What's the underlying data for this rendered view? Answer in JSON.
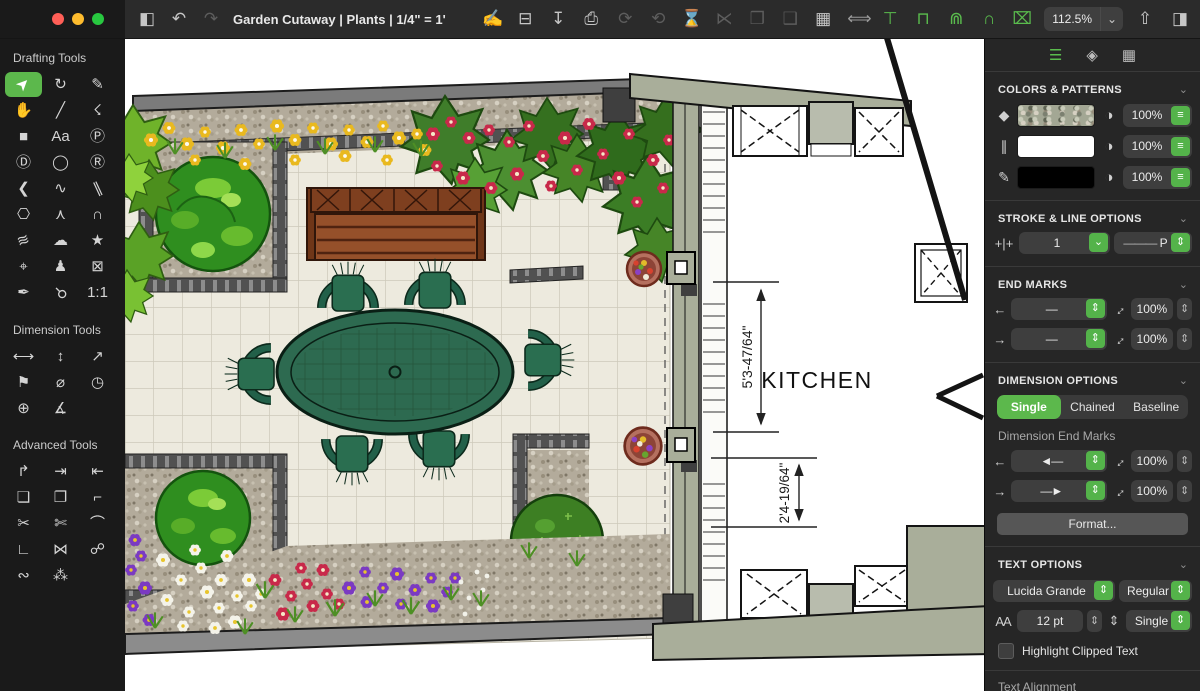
{
  "window": {
    "title": "Garden Cutaway | Plants | 1/4\" = 1'"
  },
  "colors": {
    "accent_green": "#5abc4d",
    "selected_tool_bg": "#5cb84c",
    "titlebar_bg": "#2b2b2b",
    "sidebar_bg": "#1a1a1a",
    "panel_bg": "#262626",
    "traffic": [
      "#ff5f57",
      "#febc2e",
      "#28c840"
    ]
  },
  "titlebar": {
    "nav": [
      {
        "name": "sidebar-toggle-icon",
        "glyph": "◧"
      },
      {
        "name": "undo-icon",
        "glyph": "↶"
      },
      {
        "name": "redo-icon",
        "glyph": "↷",
        "disabled": true
      }
    ],
    "file_tools": [
      {
        "name": "new-document-icon",
        "glyph": "✍"
      },
      {
        "name": "open-folder-icon",
        "glyph": "⊟"
      },
      {
        "name": "import-icon",
        "glyph": "↧"
      },
      {
        "name": "print-icon",
        "glyph": "⎙"
      }
    ],
    "edit_tools": [
      {
        "name": "rotate-cw-icon",
        "glyph": "⟳",
        "disabled": true
      },
      {
        "name": "rotate-ccw-icon",
        "glyph": "⟲",
        "disabled": true
      },
      {
        "name": "flip-vertical-icon",
        "glyph": "⌛",
        "disabled": true
      },
      {
        "name": "flip-horizontal-icon",
        "glyph": "⋉",
        "disabled": true
      },
      {
        "name": "group-icon",
        "glyph": "❒",
        "disabled": true
      },
      {
        "name": "ungroup-icon",
        "glyph": "❑",
        "disabled": true
      },
      {
        "name": "grid-icon",
        "glyph": "▦"
      }
    ],
    "dimension_tools": [
      {
        "name": "dimension-line-icon",
        "glyph": "⟺",
        "gray": true
      },
      {
        "name": "dimension-text-icon",
        "glyph": "⊤",
        "green": true
      },
      {
        "name": "dimension-arc-icon",
        "glyph": "⊓",
        "green": true
      },
      {
        "name": "dimension-double-arc-icon",
        "glyph": "⋒",
        "green": true
      },
      {
        "name": "dimension-over-arc-icon",
        "glyph": "∩",
        "green": true
      },
      {
        "name": "dimension-xy-icon",
        "glyph": "⌧",
        "green": true
      }
    ],
    "zoom": {
      "value": "112.5%",
      "chevron": "⌄"
    },
    "right_tools": [
      {
        "name": "share-icon",
        "glyph": "⇧"
      },
      {
        "name": "inspector-toggle-icon",
        "glyph": "◨"
      }
    ]
  },
  "sidebar": {
    "drafting_title": "Drafting Tools",
    "dimension_title": "Dimension Tools",
    "advanced_title": "Advanced Tools",
    "drafting_tools": [
      {
        "name": "select-tool",
        "glyph": "➤",
        "rot": -45,
        "selected": true
      },
      {
        "name": "rotate-tool",
        "glyph": "↻"
      },
      {
        "name": "reshape-tool",
        "glyph": "✎"
      },
      {
        "name": "pan-tool",
        "glyph": "✋"
      },
      {
        "name": "line-tool",
        "glyph": "╱"
      },
      {
        "name": "polyline-tool",
        "glyph": "☇"
      },
      {
        "name": "rectangle-tool",
        "glyph": "■"
      },
      {
        "name": "text-tool",
        "glyph": "Aa"
      },
      {
        "name": "text-box-tool",
        "glyph": "Ⓟ"
      },
      {
        "name": "circle-diameter-tool",
        "glyph": "Ⓓ"
      },
      {
        "name": "oval-tool",
        "glyph": "◯"
      },
      {
        "name": "rotated-rect-tool",
        "glyph": "Ⓡ"
      },
      {
        "name": "chevron-tool",
        "glyph": "❮"
      },
      {
        "name": "curve-tool",
        "glyph": "∿"
      },
      {
        "name": "parallel-line-tool",
        "glyph": "∥",
        "rot": -25
      },
      {
        "name": "polygon-tool",
        "glyph": "⎔"
      },
      {
        "name": "bezier-tool",
        "glyph": "⋏"
      },
      {
        "name": "arc-tool",
        "glyph": "∩"
      },
      {
        "name": "scribble-tool",
        "glyph": "≋",
        "rot": -20
      },
      {
        "name": "blob-tool",
        "glyph": "☁"
      },
      {
        "name": "star-tool",
        "glyph": "★"
      },
      {
        "name": "position-tool",
        "glyph": "⌖"
      },
      {
        "name": "stamp-tool",
        "glyph": "♟"
      },
      {
        "name": "no-fill-box-tool",
        "glyph": "⊠"
      },
      {
        "name": "eyedropper-tool",
        "glyph": "✒"
      },
      {
        "name": "magnifier-tool",
        "glyph": "⚲",
        "rot": 135
      },
      {
        "name": "actual-size-tool",
        "glyph": "1:1"
      }
    ],
    "dimension_tools": [
      {
        "name": "horizontal-dimension-tool",
        "glyph": "⟷"
      },
      {
        "name": "vertical-dimension-tool",
        "glyph": "↕"
      },
      {
        "name": "diagonal-dimension-tool",
        "glyph": "↗"
      },
      {
        "name": "angled-dimension-tool",
        "glyph": "⚑"
      },
      {
        "name": "diameter-dimension-tool",
        "glyph": "⌀"
      },
      {
        "name": "radius-dimension-tool",
        "glyph": "◷"
      },
      {
        "name": "center-dimension-tool",
        "glyph": "⊕"
      },
      {
        "name": "angle-dimension-tool",
        "glyph": "∡"
      }
    ],
    "advanced_tools": [
      {
        "name": "insert-vertex-tool",
        "glyph": "↱"
      },
      {
        "name": "extend-left-tool",
        "glyph": "⇥"
      },
      {
        "name": "extend-right-tool",
        "glyph": "⇤"
      },
      {
        "name": "combine-fill-tool",
        "glyph": "❏"
      },
      {
        "name": "combine-outline-tool",
        "glyph": "❐"
      },
      {
        "name": "path-node-tool",
        "glyph": "⌐"
      },
      {
        "name": "cut-tool",
        "glyph": "✂"
      },
      {
        "name": "multi-cut-tool",
        "glyph": "✄"
      },
      {
        "name": "fillet-tool",
        "glyph": "⌒"
      },
      {
        "name": "chamfer-tool",
        "glyph": "∟"
      },
      {
        "name": "mirror-tool",
        "glyph": "⋈"
      },
      {
        "name": "link-tool",
        "glyph": "☍"
      },
      {
        "name": "chain-tool",
        "glyph": "∾"
      },
      {
        "name": "distribute-tool",
        "glyph": "⁂"
      }
    ]
  },
  "inspector": {
    "tabs": [
      {
        "name": "tab-style",
        "glyph": "☰",
        "active": true
      },
      {
        "name": "tab-layers",
        "glyph": "◈"
      },
      {
        "name": "tab-library",
        "glyph": "▦"
      }
    ],
    "colors": {
      "title": "COLORS & PATTERNS",
      "rows": [
        {
          "name": "fill-row",
          "icon_name": "droplet-icon",
          "icon_glyph": "◆",
          "swatch": "pattern",
          "opacity": "100%"
        },
        {
          "name": "hatch-row",
          "icon_name": "hatch-lines-icon",
          "icon_glyph": "∥",
          "swatch": "#ffffff",
          "opacity": "100%"
        },
        {
          "name": "pen-row",
          "icon_name": "pencil-icon",
          "icon_glyph": "✎",
          "swatch": "#000000",
          "opacity": "100%"
        }
      ]
    },
    "stroke": {
      "title": "STROKE & LINE OPTIONS",
      "width_icon": "+|+",
      "width": "1",
      "style_preview": "———",
      "style_label": "P"
    },
    "end_marks": {
      "title": "END MARKS",
      "rows": [
        {
          "name": "start-end-mark-row",
          "dir_glyph": "←",
          "preview": "—",
          "scale": "100%"
        },
        {
          "name": "finish-end-mark-row",
          "dir_glyph": "→",
          "preview": "—",
          "scale": "100%"
        }
      ]
    },
    "dimension": {
      "title": "DIMENSION OPTIONS",
      "modes": [
        {
          "name": "mode-single",
          "label": "Single",
          "active": true
        },
        {
          "name": "mode-chained",
          "label": "Chained"
        },
        {
          "name": "mode-baseline",
          "label": "Baseline"
        }
      ],
      "end_marks_label": "Dimension End Marks",
      "rows": [
        {
          "name": "dim-start-mark-row",
          "dir_glyph": "←",
          "preview": "◄—",
          "scale": "100%"
        },
        {
          "name": "dim-finish-mark-row",
          "dir_glyph": "→",
          "preview": "—►",
          "scale": "100%"
        }
      ],
      "format_label": "Format..."
    },
    "text": {
      "title": "TEXT OPTIONS",
      "font": "Lucida Grande",
      "weight": "Regular",
      "size_icon": "AA",
      "size": "12 pt",
      "spacing_icon": "⇕",
      "spacing": "Single",
      "highlight_label": "Highlight Clipped Text",
      "alignment_label": "Text Alignment"
    }
  },
  "canvas": {
    "kitchen_label": "KITCHEN",
    "dim_vertical": "5'3-47/64\"",
    "dim_horizontal_gap": "2'4-19/64\""
  }
}
